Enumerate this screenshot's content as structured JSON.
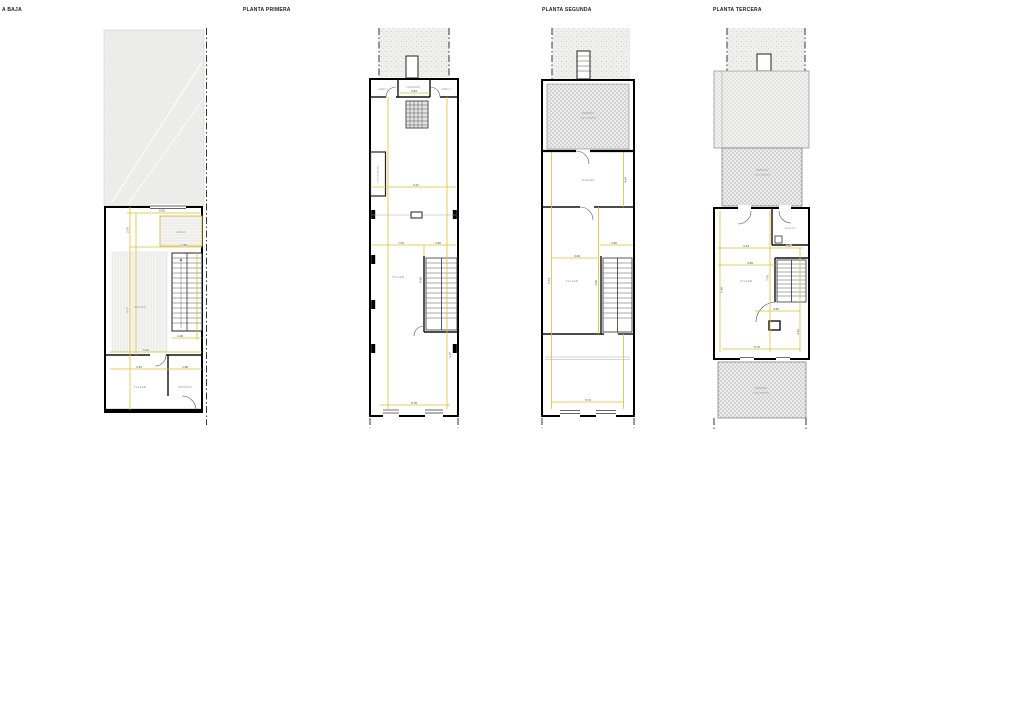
{
  "drawing": {
    "titles": {
      "plan1": "A BAJA",
      "plan2": "PLANTA PRIMERA",
      "plan3": "PLANTA SEGUNDA",
      "plan4": "PLANTA TERCERA"
    },
    "colors": {
      "wall": "#000000",
      "dimension_line": "#debf2a",
      "room_text": "#8f8f8f",
      "dim_text": "#3f3f3f",
      "hatch_light": "#f0f0ef",
      "hatch_terrace": "#d3d3d3"
    },
    "plan1": {
      "rooms": {
        "altillo": "ALTILLO",
        "estudio": "ESTUDIO",
        "taller": "TALLER",
        "vestibulo": "VESTÍBULO"
      },
      "dims": {
        "width_top": "5.52",
        "altillo_w": "2.55",
        "altillo_h": "2.76",
        "left_h": "4.77",
        "mid_w": "5.16",
        "taller_w": "3.32",
        "vestibulo_w": "1.98",
        "stair_w": "1.26"
      }
    },
    "plan2": {
      "rooms": {
        "aseo1": "ASEO 1",
        "lavadero": "LAVADERO",
        "aseo2": "ASEO 2",
        "shaft": "MONTACARGAS",
        "taller": "TALLER"
      },
      "dims": {
        "lavadero_w": "3.84",
        "upper_w": "4.27",
        "main_w": "7.04",
        "stair_w": "2.36",
        "gap": "0.60",
        "bottom_w": "5.78",
        "right_h": "4.47"
      }
    },
    "plan3": {
      "rooms": {
        "terraza": "TERRAZA",
        "terraza_floor": "SUELO ARENA",
        "almacen": "ALMACÉN",
        "taller": "TALLER"
      },
      "dims": {
        "almacen_h": "4.64",
        "stair_w": "2.36",
        "taller_w": "3.29",
        "left_h": "6.74",
        "mid_h": "4.60",
        "bottom_w": "5.74"
      }
    },
    "plan4": {
      "rooms": {
        "terraza_upper": "TERRAZA",
        "terraza_upper_floor": "SUELO ARENA",
        "almacen": "ALMACÉN",
        "taller": "TALLER",
        "terraza_lower": "TERRAZA",
        "terraza_lower_floor": "SUELO ARENA"
      },
      "dims": {
        "room_w": "3.44",
        "almacen_w": "2.37",
        "mid_w": "3.69",
        "right_h": "7.76",
        "left_h": "5.48",
        "stair_w": "3.55",
        "lower_h": "3.43",
        "bottom_w": "5.76"
      }
    }
  }
}
